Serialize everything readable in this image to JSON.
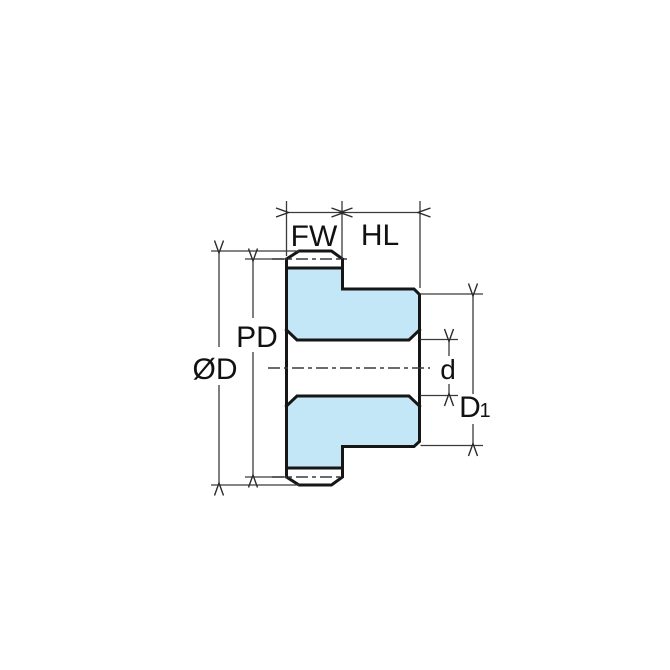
{
  "diagram": {
    "title": "spur-gear-cross-section-dimension-drawing",
    "labels": {
      "face_width": "FW",
      "hub_length": "HL",
      "pitch_diameter": "PD",
      "outside_diameter": "ØD",
      "bore_diameter": "d",
      "hub_diameter_main": "D",
      "hub_diameter_subscript": "1"
    },
    "colors": {
      "fill": "#C4E7F7",
      "outline": "#161616",
      "thin": "#3a3a3a",
      "text": "#111111",
      "background": "#ffffff"
    }
  }
}
